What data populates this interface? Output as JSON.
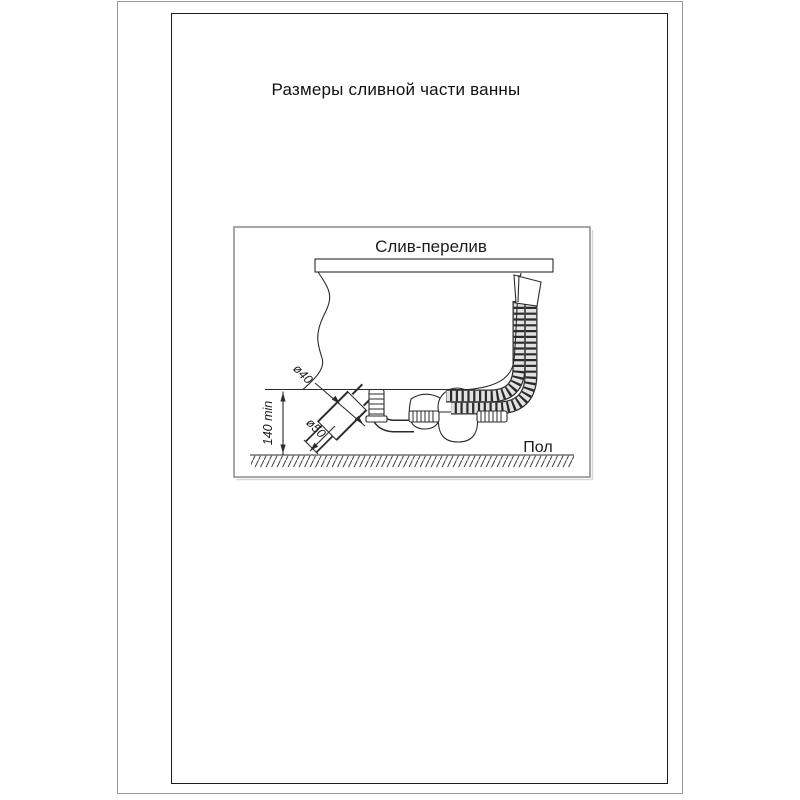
{
  "page": {
    "title": "Размеры сливной части ванны"
  },
  "diagram": {
    "title": "Слив-перелив",
    "labels": {
      "floor": "Пол",
      "height_min": "140 min",
      "dia_overflow_pipe": "ø40",
      "dia_drain_pipe": "ø50"
    }
  },
  "colors": {
    "line": "#2b2b2b",
    "page_frame": "#1c1c1c",
    "viewport_frame": "#9c9c9c",
    "diagram_frame": "#8a8a8a",
    "hose_fill": "#e2e2e2"
  }
}
